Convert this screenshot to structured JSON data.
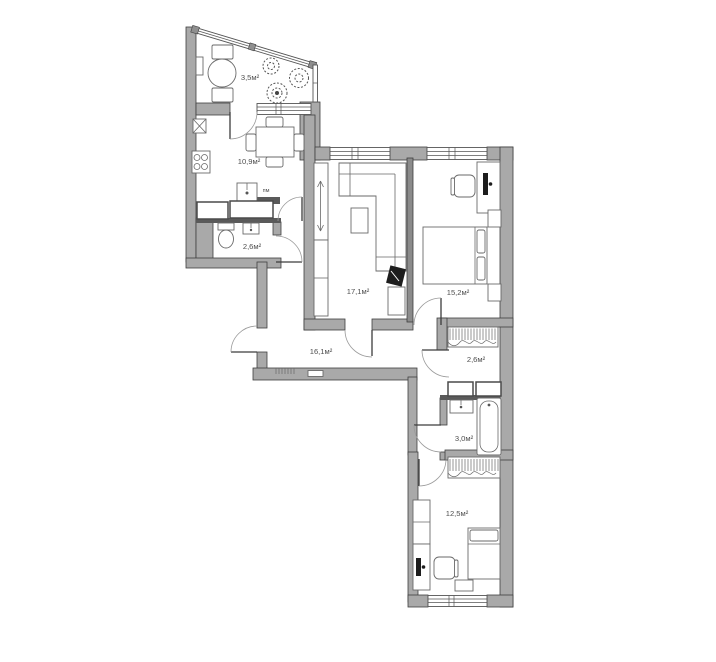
{
  "colors": {
    "wall": "#a9a9a9",
    "wall_dark": "#5a5a5a",
    "outline": "#3f3f3f",
    "glazing_block": "#8f8f8f",
    "text": "#4f4f4f"
  },
  "rooms": {
    "balcony": {
      "area": "3,5м²"
    },
    "kitchen": {
      "area": "10,9м²"
    },
    "bathroom_guest": {
      "area": "2,6м²"
    },
    "living_room": {
      "area": "17,1м²"
    },
    "bedroom_master": {
      "area": "15,2м²"
    },
    "hallway": {
      "area": "16,1м²"
    },
    "corridor": {
      "area": "2,6м²"
    },
    "bathroom_main": {
      "area": "3,0м²"
    },
    "bedroom_second": {
      "area": "12,5м²"
    }
  },
  "labels": {
    "dishwasher": "пм"
  }
}
